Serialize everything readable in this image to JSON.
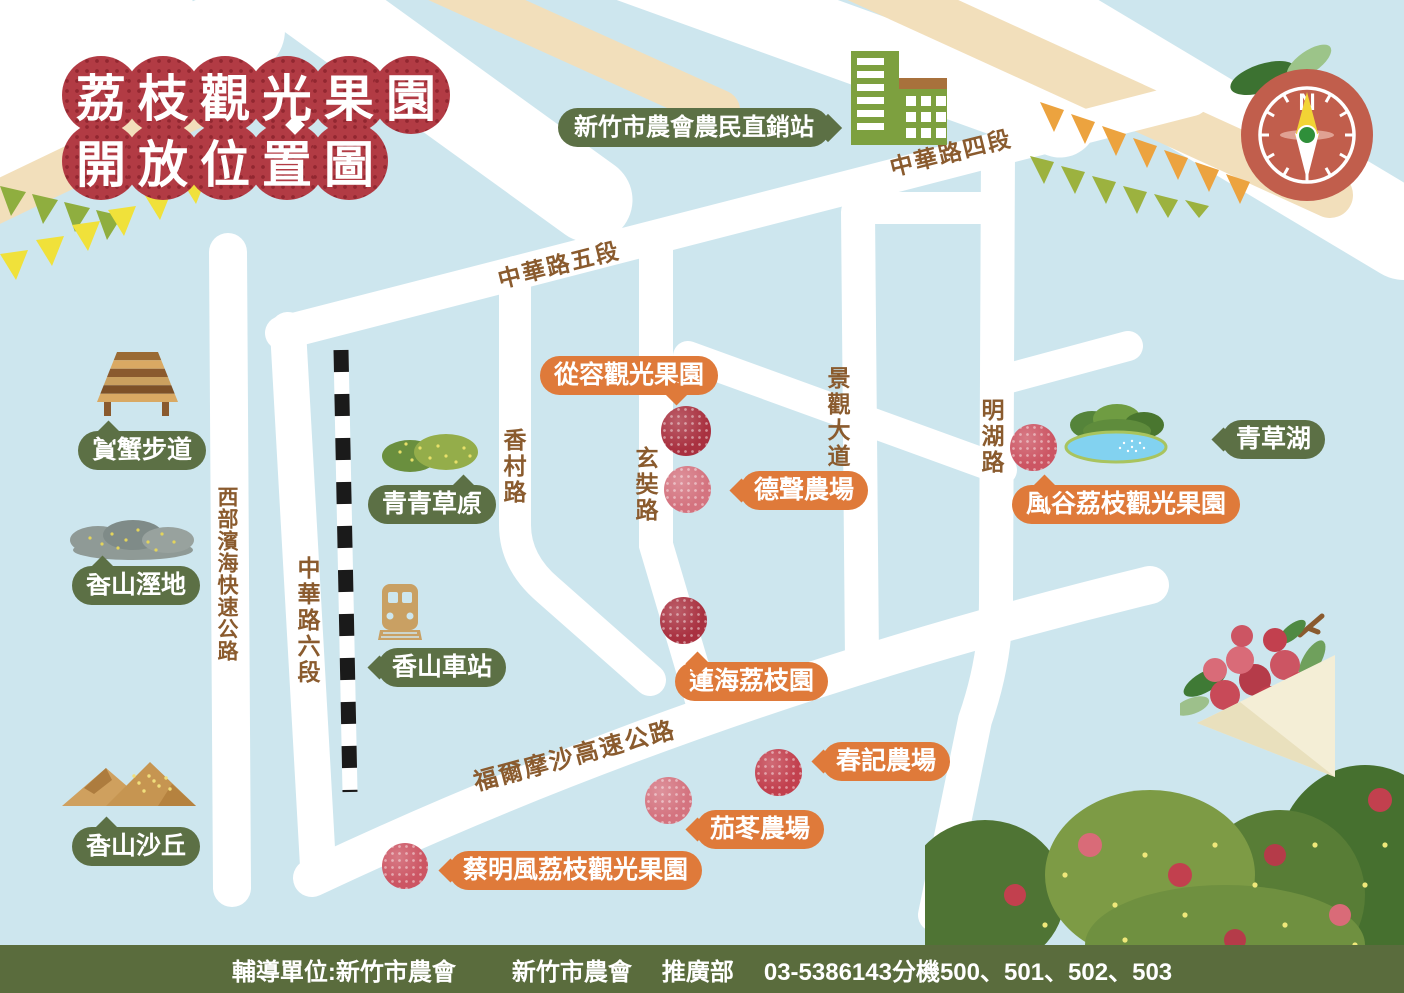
{
  "title": {
    "line1": "荔枝觀光果園",
    "line2": "開放位置圖"
  },
  "compass": {
    "label": "N"
  },
  "market": {
    "label": "新竹市農會農民直銷站"
  },
  "road_labels": {
    "zhonghua4": "中華路四段",
    "zhonghua5": "中華路五段",
    "zhonghua6": "中華路六段",
    "west_coast": "西部濱海快速公路",
    "xiangcun": "香村路",
    "xuanzang": "玄奘路",
    "jingguan": "景觀大道",
    "minghu": "明湖路",
    "formosa": "福爾摩沙高速公路"
  },
  "landmarks": {
    "crab_trail": "賞蟹步道",
    "wetland": "香山溼地",
    "grassland": "青青草原",
    "station": "香山車站",
    "dunes": "香山沙丘",
    "lake": "青草湖"
  },
  "orchards": {
    "congrong": "從容觀光果園",
    "desheng": "德聲農場",
    "lianhai": "蓮海荔枝園",
    "chunji": "春記農場",
    "qiedong": "茄苳農場",
    "caimingfeng": "蔡明風荔枝觀光果園",
    "fenggu": "風谷荔枝觀光果園"
  },
  "footer": {
    "unit": "輔導單位:新竹市農會",
    "org": "新竹市農會",
    "dept": "推廣部",
    "phone": "03-5386143分機500、501、502、503"
  },
  "colors": {
    "sky": "#cde6ee",
    "road": "#ffffff",
    "road_label": "#8a5b2e",
    "landmark_pill": "#5c7045",
    "orchard_pill": "#df7a3a",
    "title_red": "#b23b44",
    "footer_bar": "#5a6c3d",
    "lychee_dark": "#a93140",
    "lychee_pink": "#d4737f",
    "compass_body": "#c15e4c",
    "bunting_orange": "#eca33f",
    "bunting_green": "#9cb23f",
    "bunting_yellow": "#f0e13a",
    "cream": "#f2dfbb"
  }
}
